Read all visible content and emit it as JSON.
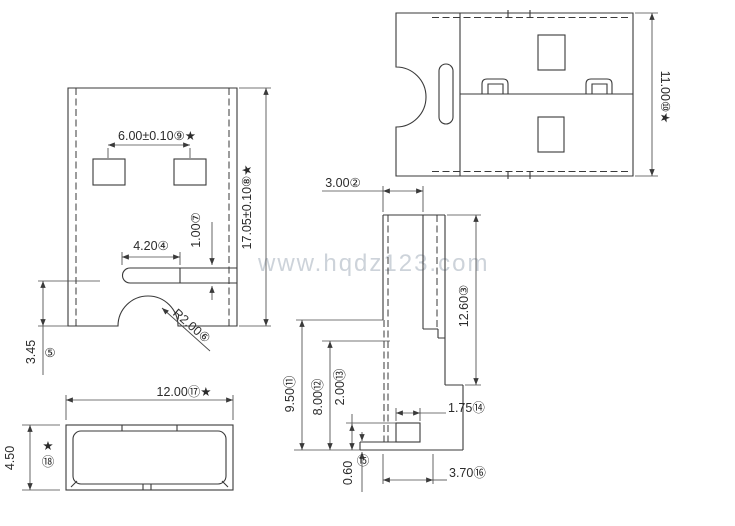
{
  "watermark": {
    "text": "www.hqdz123.com",
    "color": "#cdd3da"
  },
  "drawing": {
    "line_color": "#3a3a3a",
    "background": "#ffffff",
    "views": {
      "front": {
        "dims": {
          "pin_pitch": "6.00±0.10⑨★",
          "height": "17.05±0.10⑧★",
          "slot_height": "1.00⑦",
          "slot_width": "4.20④",
          "corner_radius": "R2.00⑥",
          "left_height": "3.45",
          "left_height_badge": "⑤"
        }
      },
      "top": {
        "dims": {
          "width": "11.00⑩★"
        }
      },
      "side": {
        "dims": {
          "top_width": "3.00②",
          "body_height": "12.60③",
          "overall_height": "9.50⑪",
          "inner_height": "8.00⑫",
          "foot_height": "2.00⑬",
          "foot_width": "1.75⑭",
          "lip_height": "0.60",
          "lip_badge": "⑮",
          "base_width": "3.70⑯"
        }
      },
      "bottom": {
        "dims": {
          "width": "12.00⑰★",
          "height": "4.50",
          "height_star": "★",
          "height_badge": "⑱"
        }
      }
    }
  }
}
